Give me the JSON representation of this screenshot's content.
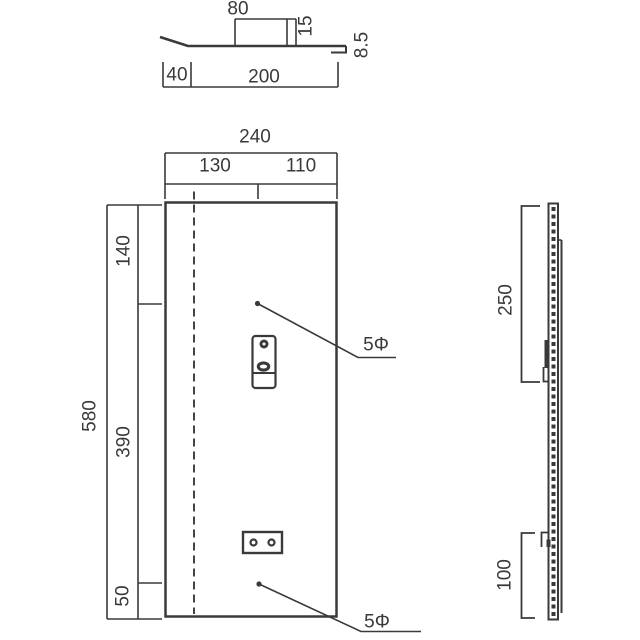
{
  "drawing": {
    "background_color": "#ffffff",
    "line_color": "#3a3a38",
    "views": {
      "top_section": {
        "dimensions": {
          "raised_width": "80",
          "offset": "15",
          "lip_depth": "8.5",
          "bend": "40",
          "base_width": "200"
        }
      },
      "front": {
        "dimensions": {
          "overall_width": "240",
          "left_span": "130",
          "right_span": "110",
          "top_span": "140",
          "middle_span": "390",
          "bottom_span": "50",
          "overall_height": "580"
        },
        "hole_label_top": "5Φ",
        "hole_label_bottom": "5Φ"
      },
      "side": {
        "dimensions": {
          "upper_span": "250",
          "lower_span": "100"
        }
      }
    }
  },
  "labels": {
    "d80": "80",
    "d15": "15",
    "d8_5": "8.5",
    "d40": "40",
    "d200": "200",
    "d240": "240",
    "d130": "130",
    "d110": "110",
    "d140": "140",
    "d390": "390",
    "d50": "50",
    "d580": "580",
    "phi_top": "5Φ",
    "phi_bottom": "5Φ",
    "d250": "250",
    "d100": "100"
  }
}
